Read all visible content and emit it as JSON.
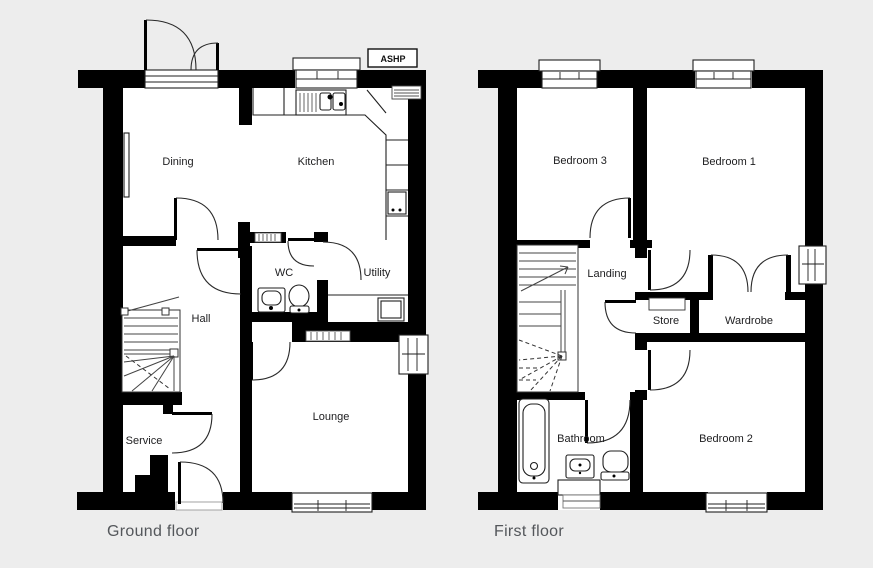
{
  "colors": {
    "background": "#ededed",
    "plan_fill": "#ffffff",
    "wall": "#000000",
    "caption_text": "#54575b",
    "label_text": "#1d1d1f"
  },
  "ground_floor": {
    "caption": "Ground floor",
    "equipment_label": "ASHP",
    "rooms": {
      "dining": "Dining",
      "kitchen": "Kitchen",
      "wc": "WC",
      "utility": "Utility",
      "hall": "Hall",
      "service": "Service",
      "lounge": "Lounge"
    }
  },
  "first_floor": {
    "caption": "First floor",
    "rooms": {
      "bedroom3": "Bedroom 3",
      "bedroom1": "Bedroom 1",
      "landing": "Landing",
      "store": "Store",
      "wardrobe": "Wardrobe",
      "bathroom": "Bathroom",
      "bedroom2": "Bedroom 2"
    }
  }
}
